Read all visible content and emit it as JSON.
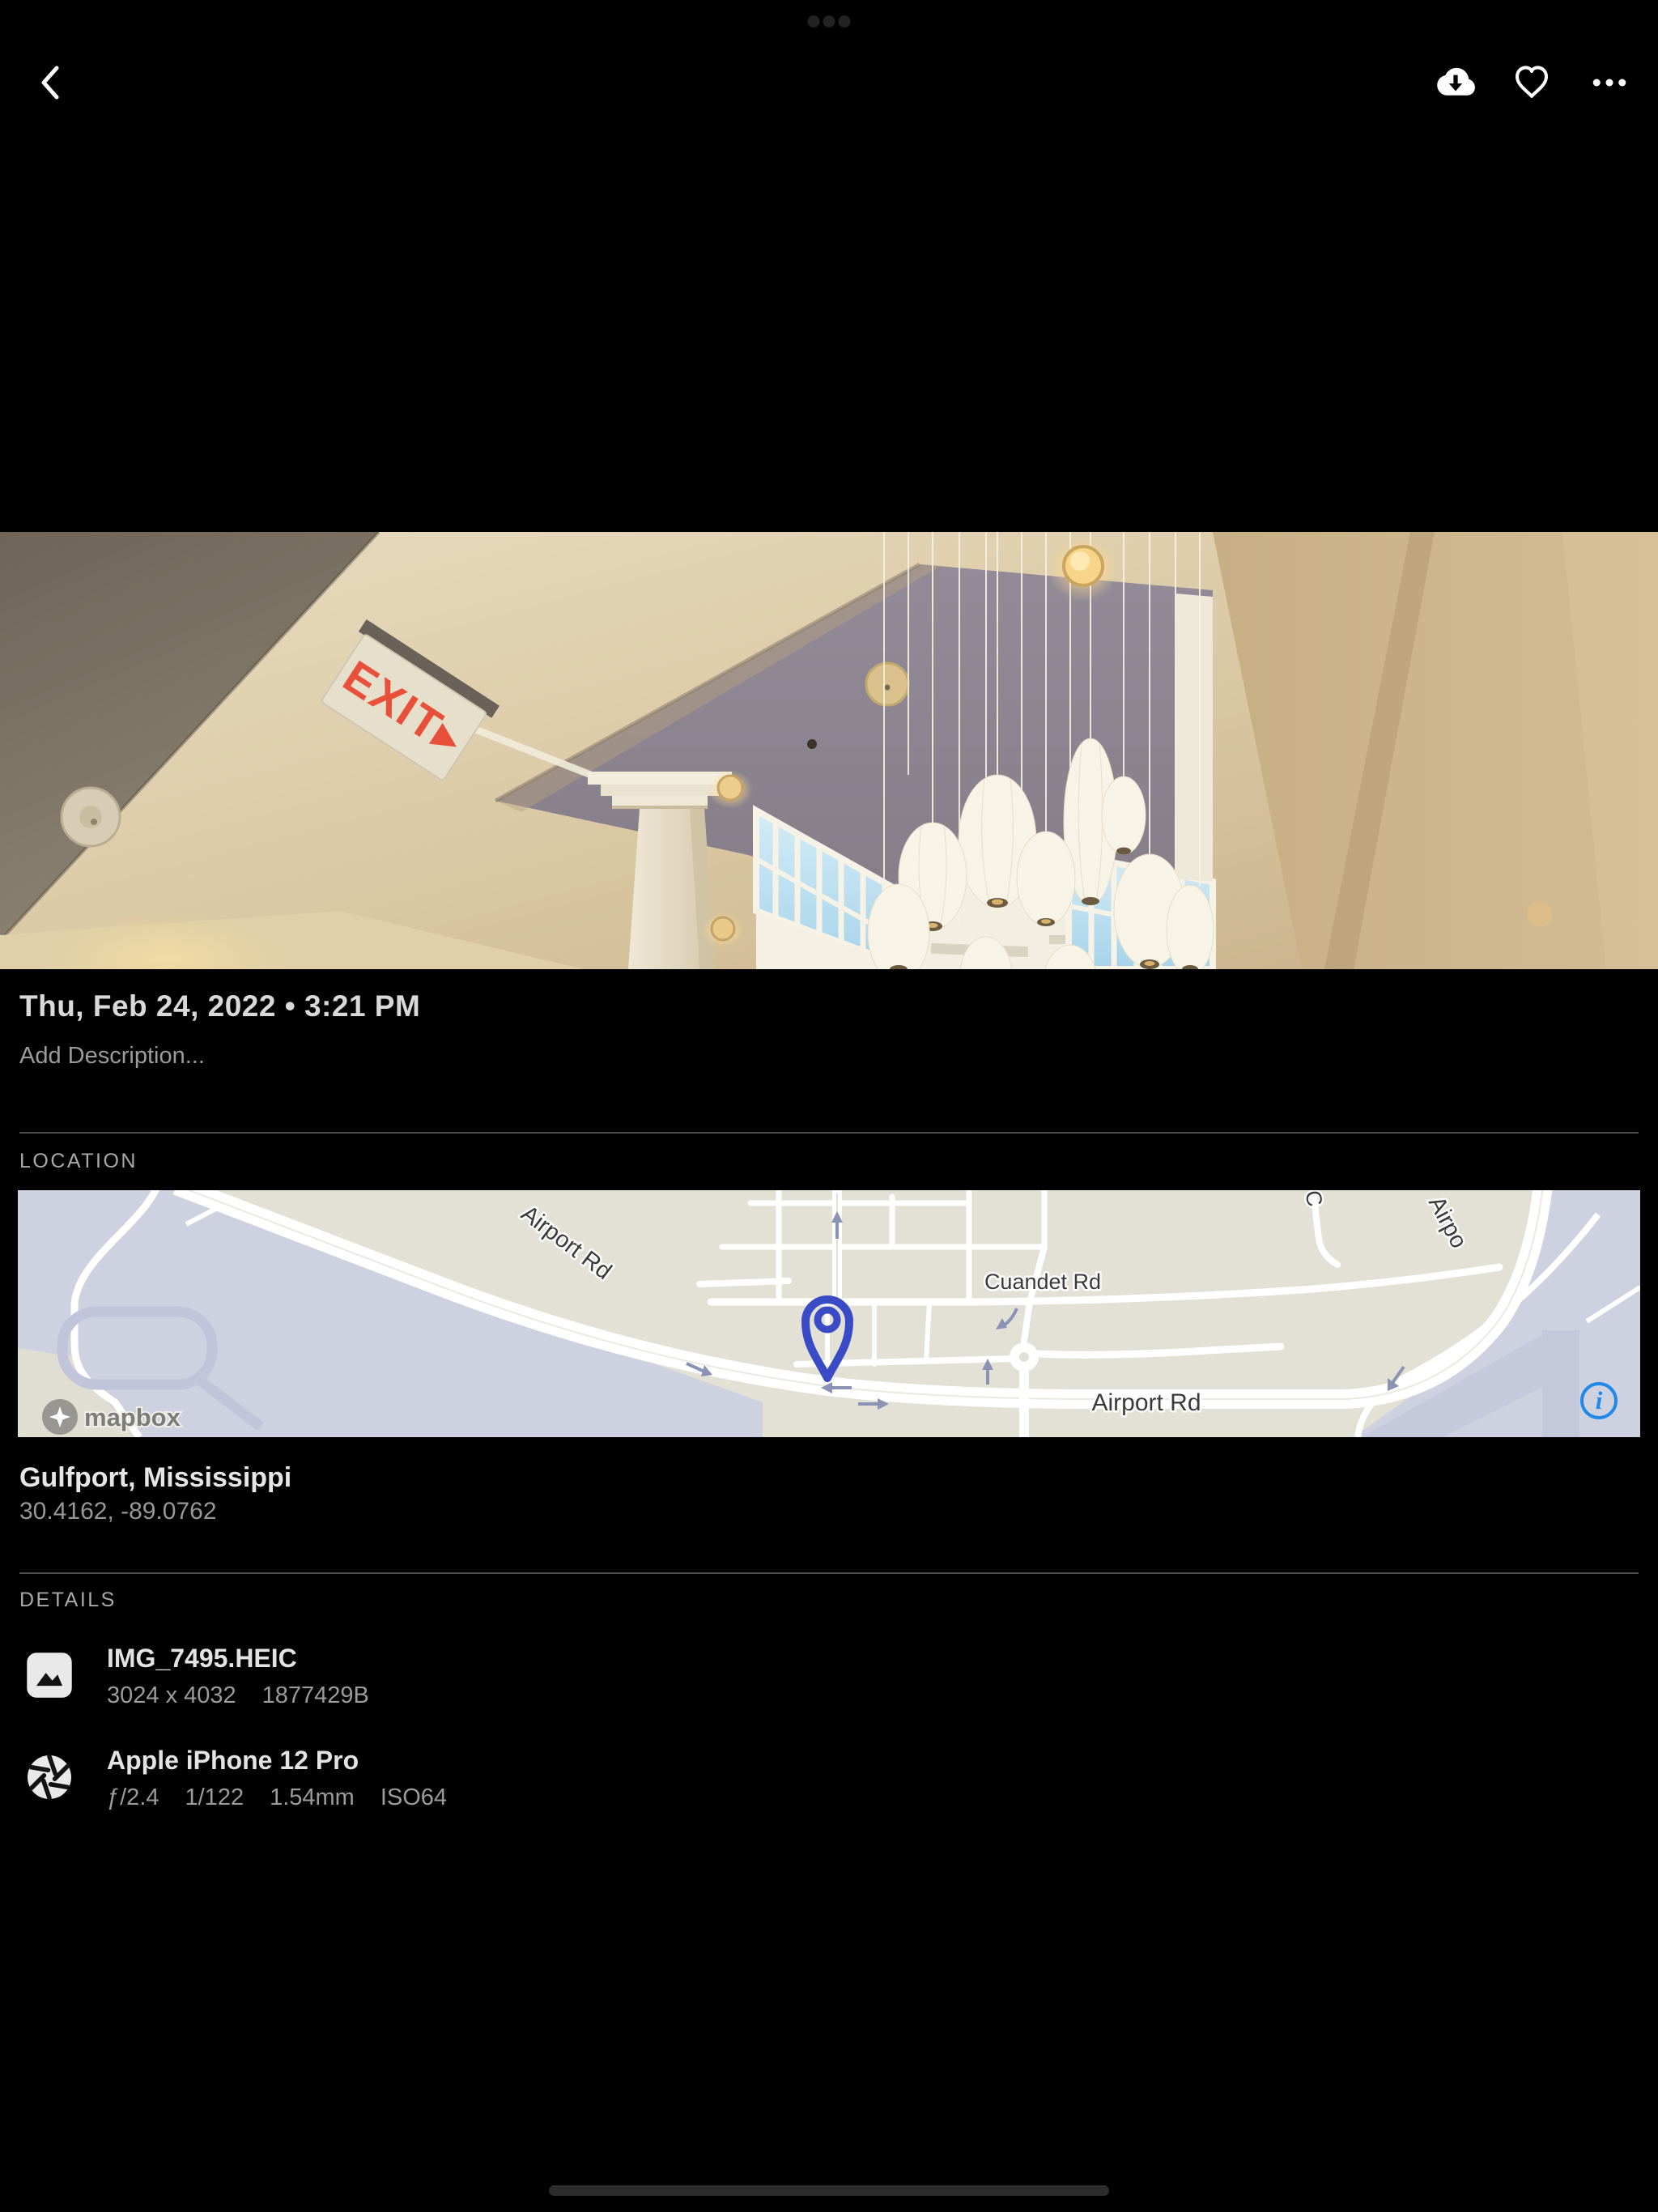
{
  "system": {
    "multitask_dot_count": 3
  },
  "toolbar": {
    "icons": [
      "back-chevron",
      "cloud-download",
      "heart-outline",
      "more-ellipsis"
    ]
  },
  "photo": {
    "exit_sign": "EXIT▸"
  },
  "meta": {
    "datetime": "Thu, Feb 24, 2022 • 3:21 PM",
    "description_placeholder": "Add Description..."
  },
  "location": {
    "header": "LOCATION",
    "place": "Gulfport, Mississippi",
    "coordinates": "30.4162, -89.0762",
    "map": {
      "labels": {
        "airport_rd_diagonal": "Airport Rd",
        "cuandet_rd": "Cuandet Rd",
        "airport_rd_horizontal": "Airport Rd",
        "airport_rd_curve_partial": "Airpo",
        "cross_street_partial": "C"
      },
      "attribution": {
        "logo_text": "mapbox",
        "info_glyph": "i"
      },
      "colors": {
        "pin": "#3a4bc6",
        "info_blue": "#1f88e8",
        "land": "#e3e0d6",
        "area_lavender": "#cdd1e0",
        "road": "#ffffff"
      }
    }
  },
  "details": {
    "header": "DETAILS",
    "rows": [
      {
        "icon": "image",
        "title": "IMG_7495.HEIC",
        "meta": [
          "3024 x 4032",
          "1877429B"
        ]
      },
      {
        "icon": "aperture",
        "title": "Apple iPhone 12 Pro",
        "meta": [
          "ƒ/2.4",
          "1/122",
          "1.54mm",
          "ISO64"
        ]
      }
    ]
  }
}
